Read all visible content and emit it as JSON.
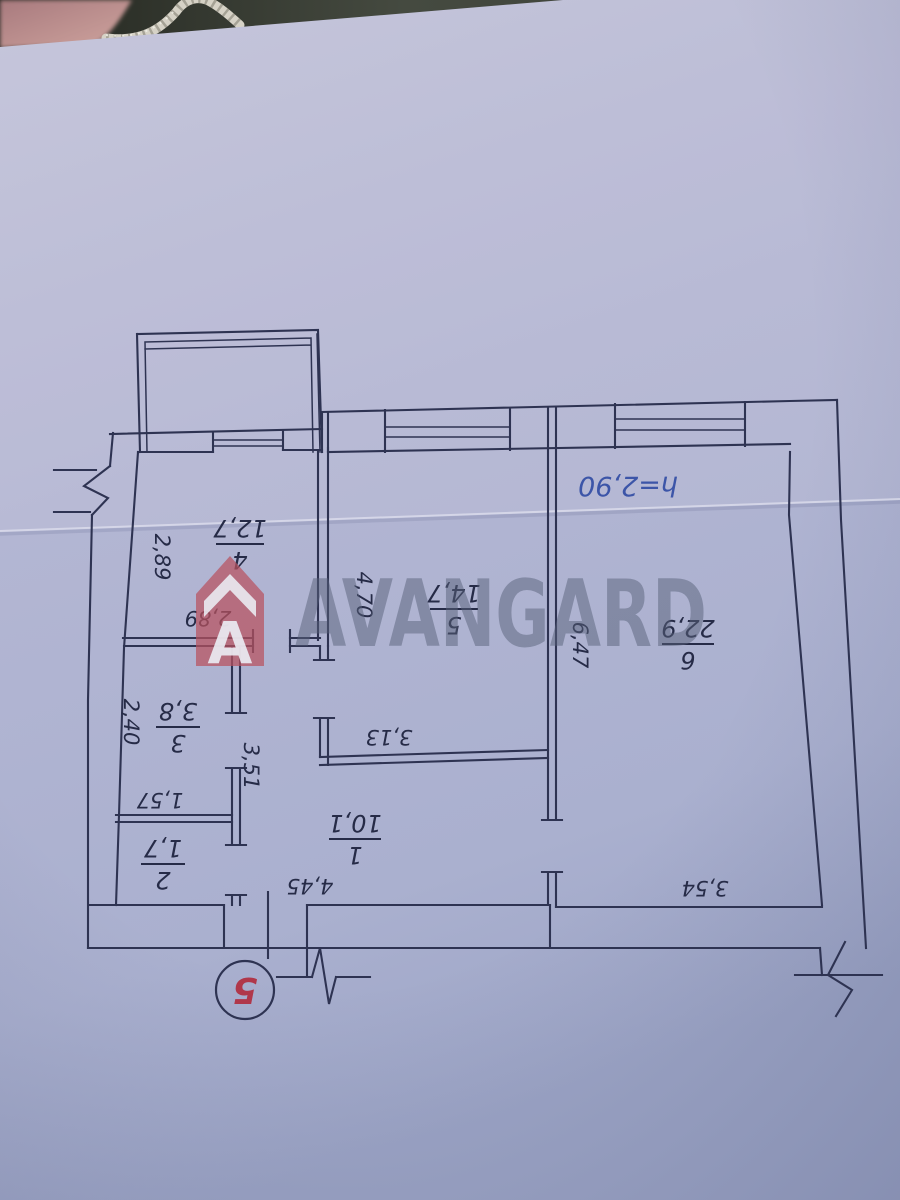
{
  "photo": {
    "watermark": {
      "brand": "AVANGARD",
      "logo_letter": "A"
    },
    "stamp": {
      "number": "5"
    },
    "note": {
      "height": "h=2,90"
    },
    "colors": {
      "ink": "#2e3352",
      "blue_ink": "#3c55a8",
      "red_ink": "#b0374a",
      "logo_red": "#b9525e",
      "watermark_grey": "#59627a",
      "paper": "#b3b6d3"
    }
  },
  "floorplan": {
    "rooms": [
      {
        "number": "1",
        "area": "10,1"
      },
      {
        "number": "2",
        "area": "1,7"
      },
      {
        "number": "3",
        "area": "3,8"
      },
      {
        "number": "4",
        "area": "12,7"
      },
      {
        "number": "5",
        "area": "14,7"
      },
      {
        "number": "6",
        "area": "22,9"
      }
    ],
    "dimensions": {
      "hall_width": "4,45",
      "room3_height": "2,40",
      "room3_width": "1,57",
      "room4_side_a": "2,89",
      "room4_side_b": "2,89",
      "corridor_length": "3,51",
      "room5_height": "4,70",
      "room5_width": "3,13",
      "room6_height": "6,47",
      "room6_width": "3,54"
    }
  }
}
